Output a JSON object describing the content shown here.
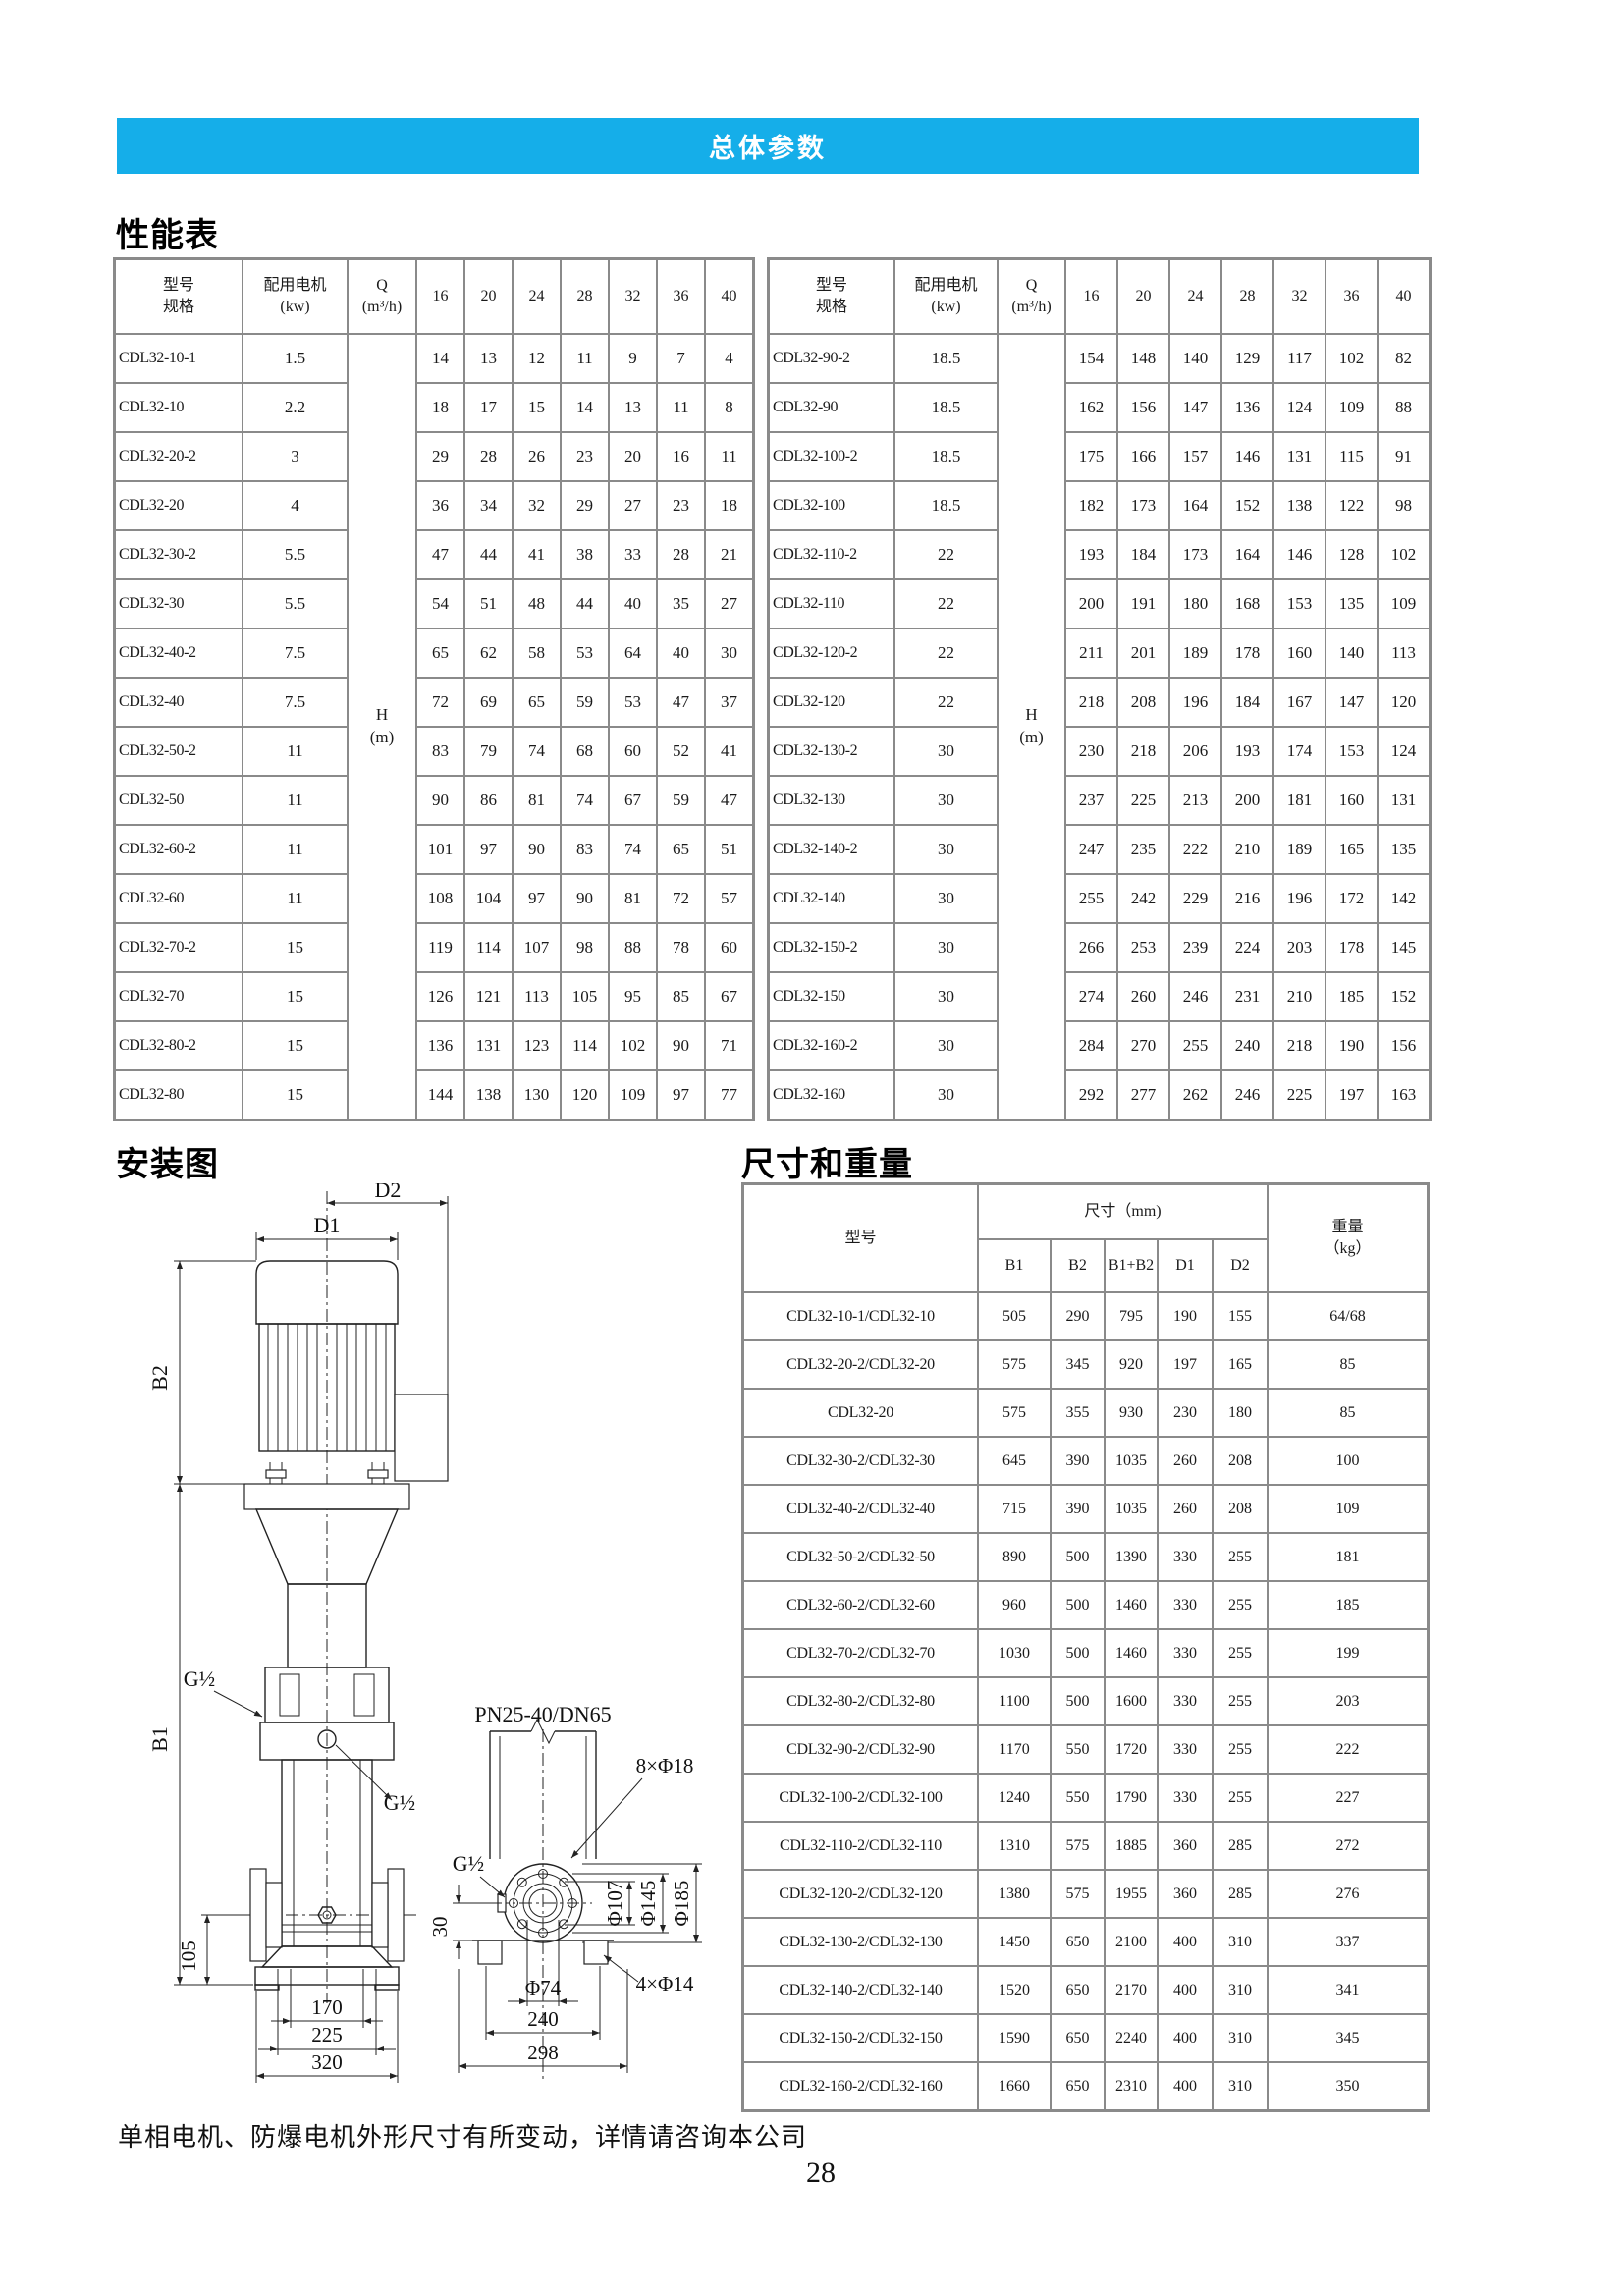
{
  "banner": {
    "title": "总体参数"
  },
  "headings": {
    "performance": "性能表",
    "installation": "安装图",
    "dimensions": "尺寸和重量"
  },
  "perf_header": {
    "model": "型号\n规格",
    "motor": "配用电机\n(kw)",
    "q": "Q\n(m³/h)",
    "flows": [
      "16",
      "20",
      "24",
      "28",
      "32",
      "36",
      "40"
    ],
    "h_label": "H\n(m)"
  },
  "perf_left": [
    {
      "model": "CDL32-10-1",
      "kw": "1.5",
      "h": [
        "14",
        "13",
        "12",
        "11",
        "9",
        "7",
        "4"
      ]
    },
    {
      "model": "CDL32-10",
      "kw": "2.2",
      "h": [
        "18",
        "17",
        "15",
        "14",
        "13",
        "11",
        "8"
      ]
    },
    {
      "model": "CDL32-20-2",
      "kw": "3",
      "h": [
        "29",
        "28",
        "26",
        "23",
        "20",
        "16",
        "11"
      ]
    },
    {
      "model": "CDL32-20",
      "kw": "4",
      "h": [
        "36",
        "34",
        "32",
        "29",
        "27",
        "23",
        "18"
      ]
    },
    {
      "model": "CDL32-30-2",
      "kw": "5.5",
      "h": [
        "47",
        "44",
        "41",
        "38",
        "33",
        "28",
        "21"
      ]
    },
    {
      "model": "CDL32-30",
      "kw": "5.5",
      "h": [
        "54",
        "51",
        "48",
        "44",
        "40",
        "35",
        "27"
      ]
    },
    {
      "model": "CDL32-40-2",
      "kw": "7.5",
      "h": [
        "65",
        "62",
        "58",
        "53",
        "64",
        "40",
        "30"
      ]
    },
    {
      "model": "CDL32-40",
      "kw": "7.5",
      "h": [
        "72",
        "69",
        "65",
        "59",
        "53",
        "47",
        "37"
      ]
    },
    {
      "model": "CDL32-50-2",
      "kw": "11",
      "h": [
        "83",
        "79",
        "74",
        "68",
        "60",
        "52",
        "41"
      ]
    },
    {
      "model": "CDL32-50",
      "kw": "11",
      "h": [
        "90",
        "86",
        "81",
        "74",
        "67",
        "59",
        "47"
      ]
    },
    {
      "model": "CDL32-60-2",
      "kw": "11",
      "h": [
        "101",
        "97",
        "90",
        "83",
        "74",
        "65",
        "51"
      ]
    },
    {
      "model": "CDL32-60",
      "kw": "11",
      "h": [
        "108",
        "104",
        "97",
        "90",
        "81",
        "72",
        "57"
      ]
    },
    {
      "model": "CDL32-70-2",
      "kw": "15",
      "h": [
        "119",
        "114",
        "107",
        "98",
        "88",
        "78",
        "60"
      ]
    },
    {
      "model": "CDL32-70",
      "kw": "15",
      "h": [
        "126",
        "121",
        "113",
        "105",
        "95",
        "85",
        "67"
      ]
    },
    {
      "model": "CDL32-80-2",
      "kw": "15",
      "h": [
        "136",
        "131",
        "123",
        "114",
        "102",
        "90",
        "71"
      ]
    },
    {
      "model": "CDL32-80",
      "kw": "15",
      "h": [
        "144",
        "138",
        "130",
        "120",
        "109",
        "97",
        "77"
      ]
    }
  ],
  "perf_right": [
    {
      "model": "CDL32-90-2",
      "kw": "18.5",
      "h": [
        "154",
        "148",
        "140",
        "129",
        "117",
        "102",
        "82"
      ]
    },
    {
      "model": "CDL32-90",
      "kw": "18.5",
      "h": [
        "162",
        "156",
        "147",
        "136",
        "124",
        "109",
        "88"
      ]
    },
    {
      "model": "CDL32-100-2",
      "kw": "18.5",
      "h": [
        "175",
        "166",
        "157",
        "146",
        "131",
        "115",
        "91"
      ]
    },
    {
      "model": "CDL32-100",
      "kw": "18.5",
      "h": [
        "182",
        "173",
        "164",
        "152",
        "138",
        "122",
        "98"
      ]
    },
    {
      "model": "CDL32-110-2",
      "kw": "22",
      "h": [
        "193",
        "184",
        "173",
        "164",
        "146",
        "128",
        "102"
      ]
    },
    {
      "model": "CDL32-110",
      "kw": "22",
      "h": [
        "200",
        "191",
        "180",
        "168",
        "153",
        "135",
        "109"
      ]
    },
    {
      "model": "CDL32-120-2",
      "kw": "22",
      "h": [
        "211",
        "201",
        "189",
        "178",
        "160",
        "140",
        "113"
      ]
    },
    {
      "model": "CDL32-120",
      "kw": "22",
      "h": [
        "218",
        "208",
        "196",
        "184",
        "167",
        "147",
        "120"
      ]
    },
    {
      "model": "CDL32-130-2",
      "kw": "30",
      "h": [
        "230",
        "218",
        "206",
        "193",
        "174",
        "153",
        "124"
      ]
    },
    {
      "model": "CDL32-130",
      "kw": "30",
      "h": [
        "237",
        "225",
        "213",
        "200",
        "181",
        "160",
        "131"
      ]
    },
    {
      "model": "CDL32-140-2",
      "kw": "30",
      "h": [
        "247",
        "235",
        "222",
        "210",
        "189",
        "165",
        "135"
      ]
    },
    {
      "model": "CDL32-140",
      "kw": "30",
      "h": [
        "255",
        "242",
        "229",
        "216",
        "196",
        "172",
        "142"
      ]
    },
    {
      "model": "CDL32-150-2",
      "kw": "30",
      "h": [
        "266",
        "253",
        "239",
        "224",
        "203",
        "178",
        "145"
      ]
    },
    {
      "model": "CDL32-150",
      "kw": "30",
      "h": [
        "274",
        "260",
        "246",
        "231",
        "210",
        "185",
        "152"
      ]
    },
    {
      "model": "CDL32-160-2",
      "kw": "30",
      "h": [
        "284",
        "270",
        "255",
        "240",
        "218",
        "190",
        "156"
      ]
    },
    {
      "model": "CDL32-160",
      "kw": "30",
      "h": [
        "292",
        "277",
        "262",
        "246",
        "225",
        "197",
        "163"
      ]
    }
  ],
  "dims": {
    "model_header": "型号",
    "size_header": "尺寸（mm)",
    "weight_header": "重量\n（kg）",
    "cols": [
      "B1",
      "B2",
      "B1+B2",
      "D1",
      "D2"
    ],
    "rows": [
      {
        "model": "CDL32-10-1/CDL32-10",
        "vals": [
          "505",
          "290",
          "795",
          "190",
          "155"
        ],
        "weight": "64/68"
      },
      {
        "model": "CDL32-20-2/CDL32-20",
        "vals": [
          "575",
          "345",
          "920",
          "197",
          "165"
        ],
        "weight": "85"
      },
      {
        "model": "CDL32-20",
        "vals": [
          "575",
          "355",
          "930",
          "230",
          "180"
        ],
        "weight": "85"
      },
      {
        "model": "CDL32-30-2/CDL32-30",
        "vals": [
          "645",
          "390",
          "1035",
          "260",
          "208"
        ],
        "weight": "100"
      },
      {
        "model": "CDL32-40-2/CDL32-40",
        "vals": [
          "715",
          "390",
          "1035",
          "260",
          "208"
        ],
        "weight": "109"
      },
      {
        "model": "CDL32-50-2/CDL32-50",
        "vals": [
          "890",
          "500",
          "1390",
          "330",
          "255"
        ],
        "weight": "181"
      },
      {
        "model": "CDL32-60-2/CDL32-60",
        "vals": [
          "960",
          "500",
          "1460",
          "330",
          "255"
        ],
        "weight": "185"
      },
      {
        "model": "CDL32-70-2/CDL32-70",
        "vals": [
          "1030",
          "500",
          "1460",
          "330",
          "255"
        ],
        "weight": "199"
      },
      {
        "model": "CDL32-80-2/CDL32-80",
        "vals": [
          "1100",
          "500",
          "1600",
          "330",
          "255"
        ],
        "weight": "203"
      },
      {
        "model": "CDL32-90-2/CDL32-90",
        "vals": [
          "1170",
          "550",
          "1720",
          "330",
          "255"
        ],
        "weight": "222"
      },
      {
        "model": "CDL32-100-2/CDL32-100",
        "vals": [
          "1240",
          "550",
          "1790",
          "330",
          "255"
        ],
        "weight": "227"
      },
      {
        "model": "CDL32-110-2/CDL32-110",
        "vals": [
          "1310",
          "575",
          "1885",
          "360",
          "285"
        ],
        "weight": "272"
      },
      {
        "model": "CDL32-120-2/CDL32-120",
        "vals": [
          "1380",
          "575",
          "1955",
          "360",
          "285"
        ],
        "weight": "276"
      },
      {
        "model": "CDL32-130-2/CDL32-130",
        "vals": [
          "1450",
          "650",
          "2100",
          "400",
          "310"
        ],
        "weight": "337"
      },
      {
        "model": "CDL32-140-2/CDL32-140",
        "vals": [
          "1520",
          "650",
          "2170",
          "400",
          "310"
        ],
        "weight": "341"
      },
      {
        "model": "CDL32-150-2/CDL32-150",
        "vals": [
          "1590",
          "650",
          "2240",
          "400",
          "310"
        ],
        "weight": "345"
      },
      {
        "model": "CDL32-160-2/CDL32-160",
        "vals": [
          "1660",
          "650",
          "2310",
          "400",
          "310"
        ],
        "weight": "350"
      }
    ]
  },
  "diagram": {
    "d2": "D2",
    "d1": "D1",
    "b2": "B2",
    "b1": "B1",
    "g_half": "G½",
    "dim_105": "105",
    "dim_170": "170",
    "dim_225": "225",
    "dim_320": "320",
    "pn": "PN25-40/DN65",
    "bolt_top": "8×Φ18",
    "f107": "Φ107",
    "f145": "Φ145",
    "f185": "Φ185",
    "dim_30": "30",
    "f74": "Φ74",
    "dim_240": "240",
    "dim_298": "298",
    "bolt_base": "4×Φ14"
  },
  "footer": {
    "note": "单相电机、防爆电机外形尺寸有所变动，详情请咨询本公司",
    "page": "28"
  },
  "colors": {
    "banner_bg": "#15AEE9",
    "banner_fg": "#FFFFFF",
    "grid_line": "#8A8A8A"
  }
}
